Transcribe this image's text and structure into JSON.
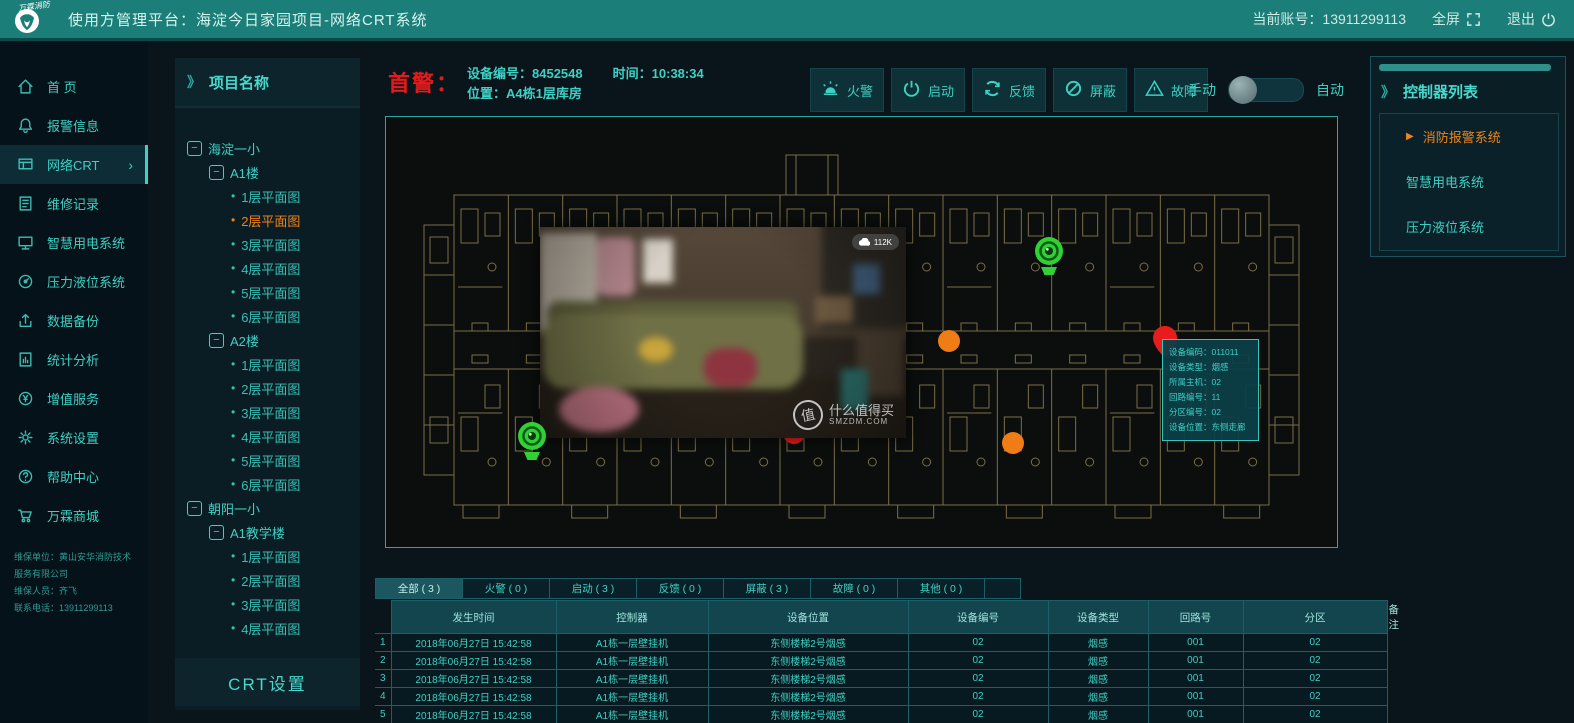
{
  "ui": {
    "panel_prefix": "》",
    "bullet": "•",
    "collapse": "−",
    "play": "▶",
    "chevron": "›"
  },
  "colors": {
    "accent": "#3fd0c4",
    "orange": "#ef8418",
    "red": "#e81c1c",
    "green": "#31d035",
    "header": "#1b7e79"
  },
  "header": {
    "logo_text": "万霖消防",
    "title": "使用方管理平台：海淀今日家园项目-网络CRT系统",
    "account": "当前账号：13911299113",
    "fullscreen_label": "全屏",
    "logout_label": "退出"
  },
  "sidebar": {
    "items": [
      {
        "label": "首  页",
        "icon": "home",
        "key": "home"
      },
      {
        "label": "报警信息",
        "icon": "bell",
        "key": "alarm-info"
      },
      {
        "label": "网络CRT",
        "icon": "crt",
        "key": "network-crt",
        "active": true,
        "chevron": true
      },
      {
        "label": "维修记录",
        "icon": "record",
        "key": "maintenance-record"
      },
      {
        "label": "智慧用电系统",
        "icon": "monitor",
        "key": "smart-power"
      },
      {
        "label": "压力液位系统",
        "icon": "gauge",
        "key": "pressure-level"
      },
      {
        "label": "数据备份",
        "icon": "upload",
        "key": "data-backup"
      },
      {
        "label": "统计分析",
        "icon": "doc",
        "key": "statistics"
      },
      {
        "label": "增值服务",
        "icon": "coin",
        "key": "value-added"
      },
      {
        "label": "系统设置",
        "icon": "gear",
        "key": "system-settings"
      },
      {
        "label": "帮助中心",
        "icon": "help",
        "key": "help-center"
      },
      {
        "label": "万霖商城",
        "icon": "cart",
        "key": "mall"
      }
    ],
    "footer": [
      "维保单位：黄山安华消防技术服务有限公司",
      "维保人员：齐飞",
      "联系电话：13911299113"
    ]
  },
  "project_panel": {
    "title": "项目名称",
    "crt_button": "CRT设置",
    "tree": [
      {
        "label": "海淀一小",
        "level": 0,
        "kind": "branch"
      },
      {
        "label": "A1楼",
        "level": 1,
        "kind": "branch"
      },
      {
        "label": "1层平面图",
        "level": 2,
        "kind": "leaf"
      },
      {
        "label": "2层平面图",
        "level": 2,
        "kind": "leaf",
        "active": true
      },
      {
        "label": "3层平面图",
        "level": 2,
        "kind": "leaf"
      },
      {
        "label": "4层平面图",
        "level": 2,
        "kind": "leaf"
      },
      {
        "label": "5层平面图",
        "level": 2,
        "kind": "leaf"
      },
      {
        "label": "6层平面图",
        "level": 2,
        "kind": "leaf"
      },
      {
        "label": "A2楼",
        "level": 1,
        "kind": "branch"
      },
      {
        "label": "1层平面图",
        "level": 2,
        "kind": "leaf"
      },
      {
        "label": "2层平面图",
        "level": 2,
        "kind": "leaf"
      },
      {
        "label": "3层平面图",
        "level": 2,
        "kind": "leaf"
      },
      {
        "label": "4层平面图",
        "level": 2,
        "kind": "leaf"
      },
      {
        "label": "5层平面图",
        "level": 2,
        "kind": "leaf"
      },
      {
        "label": "6层平面图",
        "level": 2,
        "kind": "leaf"
      },
      {
        "label": "朝阳一小",
        "level": 0,
        "kind": "branch"
      },
      {
        "label": "A1教学楼",
        "level": 1,
        "kind": "branch"
      },
      {
        "label": "1层平面图",
        "level": 2,
        "kind": "leaf"
      },
      {
        "label": "2层平面图",
        "level": 2,
        "kind": "leaf"
      },
      {
        "label": "3层平面图",
        "level": 2,
        "kind": "leaf"
      },
      {
        "label": "4层平面图",
        "level": 2,
        "kind": "leaf"
      }
    ]
  },
  "alarm": {
    "label": "首警：",
    "device_no_label": "设备编号：",
    "device_no": "8452548",
    "time_label": "时间：",
    "time": "10:38:34",
    "location_label": "位置：",
    "location": "A4栋1层库房"
  },
  "actions": {
    "buttons": [
      {
        "label": "火警",
        "icon": "siren",
        "key": "fire-alarm"
      },
      {
        "label": "启动",
        "icon": "power",
        "key": "start"
      },
      {
        "label": "反馈",
        "icon": "refresh",
        "key": "feedback"
      },
      {
        "label": "屏蔽",
        "icon": "block",
        "key": "shield"
      },
      {
        "label": "故障",
        "icon": "warn",
        "key": "fault"
      }
    ],
    "toggle": {
      "left": "手动",
      "right": "自动",
      "state": "manual"
    }
  },
  "map": {
    "markers": [
      {
        "type": "camera",
        "x": 645,
        "y": 118,
        "z": 2,
        "name": "camera-marker"
      },
      {
        "type": "camera",
        "x": 128,
        "y": 303,
        "z": 6,
        "name": "camera-marker"
      },
      {
        "type": "dot",
        "color": "#f07c15",
        "x": 552,
        "y": 213,
        "z": 1,
        "name": "device-dot-orange"
      },
      {
        "type": "dot",
        "color": "#f07c15",
        "x": 616,
        "y": 315,
        "z": 1,
        "name": "device-dot-orange"
      },
      {
        "type": "dot",
        "color": "#e81c1c",
        "x": 397,
        "y": 305,
        "z": 1,
        "name": "device-dot-red"
      },
      {
        "type": "pin",
        "x": 766,
        "y": 208,
        "z": 4,
        "name": "alarm-pin-red"
      }
    ],
    "video": {
      "badge": "112K",
      "watermark_logo": "值",
      "watermark_main": "什么值得买",
      "watermark_sub": "SMZDM.COM"
    },
    "tooltip": {
      "rows": [
        "设备编码：011011",
        "设备类型：烟感",
        "所属主机：02",
        "回路编号：11",
        "分区编号：02",
        "设备位置：东侧走廊"
      ]
    }
  },
  "controllers": {
    "title": "控制器列表",
    "items": [
      {
        "label": "消防报警系统",
        "active": true
      },
      {
        "label": "智慧用电系统"
      },
      {
        "label": "压力液位系统"
      }
    ]
  },
  "table": {
    "tabs": [
      {
        "label": "全部 ( 3 )",
        "active": true
      },
      {
        "label": "火警 ( 0 )"
      },
      {
        "label": "启动 ( 3 )"
      },
      {
        "label": "反馈 ( 0 )"
      },
      {
        "label": "屏蔽 ( 3 )"
      },
      {
        "label": "故障 ( 0 )"
      },
      {
        "label": "其他 ( 0 )"
      }
    ],
    "headers": [
      "发生时间",
      "控制器",
      "设备位置",
      "设备编号",
      "设备类型",
      "回路号",
      "分区",
      "备注"
    ],
    "rows": [
      [
        "1",
        "2018年06月27日  15:42:58",
        "A1栋一层壁挂机",
        "东侧楼梯2号烟感",
        "02",
        "烟感",
        "001",
        "02",
        ""
      ],
      [
        "2",
        "2018年06月27日  15:42:58",
        "A1栋一层壁挂机",
        "东侧楼梯2号烟感",
        "02",
        "烟感",
        "001",
        "02",
        ""
      ],
      [
        "3",
        "2018年06月27日  15:42:58",
        "A1栋一层壁挂机",
        "东侧楼梯2号烟感",
        "02",
        "烟感",
        "001",
        "02",
        ""
      ],
      [
        "4",
        "2018年06月27日  15:42:58",
        "A1栋一层壁挂机",
        "东侧楼梯2号烟感",
        "02",
        "烟感",
        "001",
        "02",
        ""
      ],
      [
        "5",
        "2018年06月27日  15:42:58",
        "A1栋一层壁挂机",
        "东侧楼梯2号烟感",
        "02",
        "烟感",
        "001",
        "02",
        ""
      ]
    ]
  }
}
